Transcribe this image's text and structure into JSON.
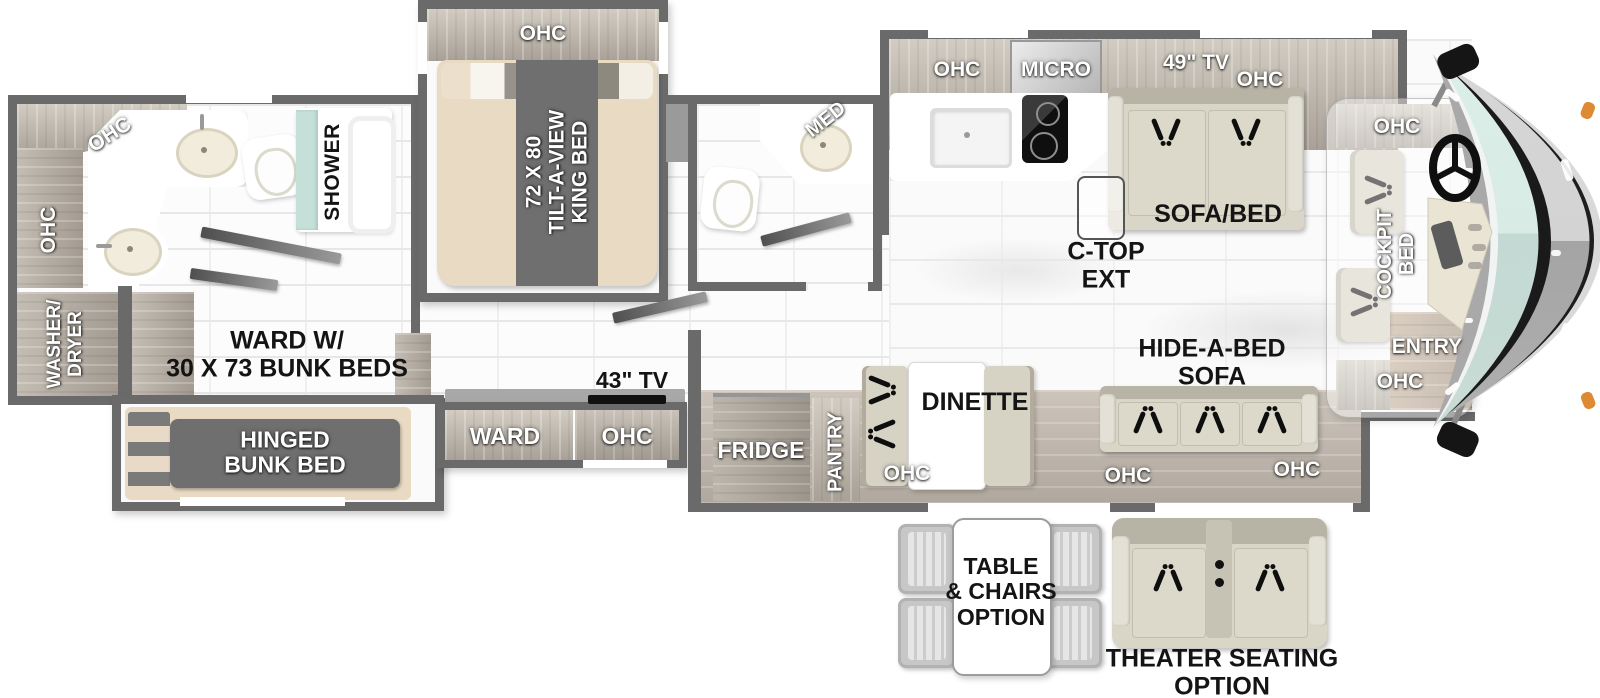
{
  "fp": {
    "rear_bath": {
      "ohc_top": "OHC",
      "ohc_side": "OHC",
      "shower": "SHOWER"
    },
    "laundry": {
      "l1": "WASHER/",
      "l2": "DRYER"
    },
    "bunk_hall": {
      "l1": "WARD W/",
      "l2": "30 X 73 BUNK BEDS"
    },
    "bunk_slide": {
      "l1": "HINGED",
      "l2": "BUNK BED"
    },
    "bedroom": {
      "ohc": "OHC",
      "bed1": "72 X 80",
      "bed2": "TILT-A-VIEW",
      "bed3": "KING BED"
    },
    "half_bath": {
      "med": "MED"
    },
    "mid_cab": {
      "tv": "43\" TV",
      "ward": "WARD",
      "ohc": "OHC"
    },
    "kitchen": {
      "ohc_left": "OHC",
      "micro": "MICRO",
      "tv": "49\" TV",
      "ohc_right": "OHC",
      "ctop1": "C-TOP",
      "ctop2": "EXT"
    },
    "living": {
      "sofa_bed": "SOFA/BED",
      "hab1": "HIDE-A-BED",
      "hab2": "SOFA",
      "ohc_a": "OHC",
      "ohc_b": "OHC"
    },
    "galley": {
      "fridge": "FRIDGE",
      "pantry": "PANTRY",
      "dinette": "DINETTE",
      "ohc": "OHC"
    },
    "cockpit": {
      "ohc_top": "OHC",
      "bed1": "COCKPIT",
      "bed2": "BED",
      "entry": "ENTRY",
      "ohc_bottom": "OHC"
    },
    "options": {
      "table1": "TABLE",
      "table2": "& CHAIRS",
      "table3": "OPTION",
      "theater1": "THEATER SEATING",
      "theater2": "OPTION"
    }
  },
  "colors": {
    "wall": "#6a6a6a",
    "shower_glass": "#c5e0d9",
    "windshield_upper": "#dceee8",
    "windshield_lower": "#c3d9d3",
    "marker_orange": "#dd8a33",
    "bed_cream": "#e9dac4",
    "mattress_gray": "#6f6f6f"
  }
}
